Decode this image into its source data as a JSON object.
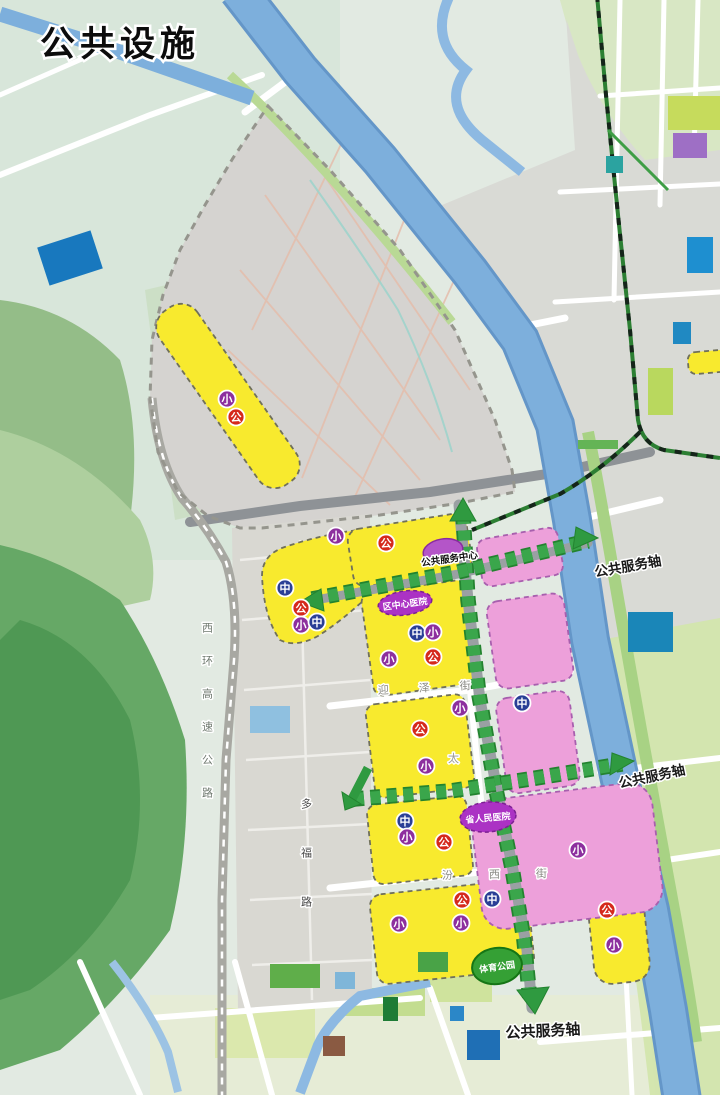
{
  "title": "公共设施",
  "map": {
    "landmarks": {
      "service_center": "公共服务中心",
      "district_hospital": "区中心医院",
      "provincial_hospital": "省人民医院",
      "sports_park": "体育公园"
    },
    "axis_labels": {
      "north": "公共服务轴",
      "east": "公共服务轴",
      "south": "公共服务轴"
    },
    "roads": {
      "expressway": "西环高速公路",
      "duofu_road": "多福路",
      "yingze_street": "迎泽街",
      "fenxi_street": "汾西街",
      "vertical_street_char": "太"
    },
    "badge_types": {
      "primary": {
        "char": "小",
        "color": "#8d2f9e"
      },
      "middle": {
        "char": "中",
        "color": "#2a3f96"
      },
      "public": {
        "char": "公",
        "color": "#d5291c"
      }
    },
    "badges": [
      {
        "type": "primary",
        "x": 227,
        "y": 399
      },
      {
        "type": "public",
        "x": 236,
        "y": 417
      },
      {
        "type": "primary",
        "x": 336,
        "y": 536
      },
      {
        "type": "public",
        "x": 386,
        "y": 543
      },
      {
        "type": "middle",
        "x": 285,
        "y": 588
      },
      {
        "type": "public",
        "x": 301,
        "y": 608
      },
      {
        "type": "primary",
        "x": 301,
        "y": 625
      },
      {
        "type": "middle",
        "x": 317,
        "y": 622
      },
      {
        "type": "middle",
        "x": 417,
        "y": 633
      },
      {
        "type": "primary",
        "x": 433,
        "y": 632
      },
      {
        "type": "primary",
        "x": 389,
        "y": 659
      },
      {
        "type": "public",
        "x": 433,
        "y": 657
      },
      {
        "type": "primary",
        "x": 460,
        "y": 708
      },
      {
        "type": "middle",
        "x": 522,
        "y": 703
      },
      {
        "type": "public",
        "x": 420,
        "y": 729
      },
      {
        "type": "primary",
        "x": 426,
        "y": 766
      },
      {
        "type": "middle",
        "x": 405,
        "y": 821
      },
      {
        "type": "primary",
        "x": 407,
        "y": 837
      },
      {
        "type": "public",
        "x": 444,
        "y": 842
      },
      {
        "type": "primary",
        "x": 578,
        "y": 850
      },
      {
        "type": "public",
        "x": 462,
        "y": 900
      },
      {
        "type": "middle",
        "x": 492,
        "y": 899
      },
      {
        "type": "primary",
        "x": 399,
        "y": 924
      },
      {
        "type": "primary",
        "x": 461,
        "y": 923
      },
      {
        "type": "public",
        "x": 607,
        "y": 910
      },
      {
        "type": "primary",
        "x": 614,
        "y": 945
      }
    ],
    "colors": {
      "yellow_zone": "#f8ea2e",
      "pink_zone": "#eda0da",
      "axis_green": "#3aa64b",
      "hospital_purple": "#ab32c4",
      "park_green": "#35a035",
      "river_blue": "#7dafdc",
      "old_town_gray": "#d5d3d0"
    }
  }
}
